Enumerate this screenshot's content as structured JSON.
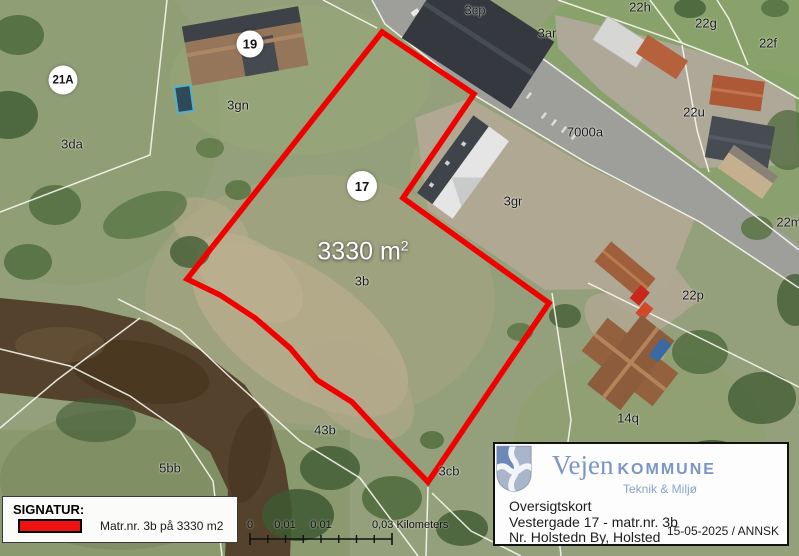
{
  "map": {
    "parcel_labels": [
      {
        "id": "3cp",
        "text": "3cp"
      },
      {
        "id": "3ar",
        "text": "3ar"
      },
      {
        "id": "22h",
        "text": "22h"
      },
      {
        "id": "22g",
        "text": "22g"
      },
      {
        "id": "22f",
        "text": "22f"
      },
      {
        "id": "7000a",
        "text": "7000a"
      },
      {
        "id": "22u",
        "text": "22u"
      },
      {
        "id": "22m",
        "text": "22m"
      },
      {
        "id": "22p",
        "text": "22p"
      },
      {
        "id": "3gn",
        "text": "3gn"
      },
      {
        "id": "3da",
        "text": "3da"
      },
      {
        "id": "3gr",
        "text": "3gr"
      },
      {
        "id": "3b",
        "text": "3b"
      },
      {
        "id": "43b",
        "text": "43b"
      },
      {
        "id": "5bb",
        "text": "5bb"
      },
      {
        "id": "3cb",
        "text": "3cb"
      },
      {
        "id": "14q",
        "text": "14q"
      }
    ],
    "address_badges": [
      {
        "text": "19"
      },
      {
        "text": "21A"
      },
      {
        "text": "17"
      }
    ],
    "area_label": {
      "value": "3330 m",
      "superscript": "2"
    },
    "highlight_color": "#f10000"
  },
  "legend": {
    "title": "SIGNATUR:",
    "swatch_color": "#ee1212",
    "entry": "Matr.nr. 3b på 3330 m2"
  },
  "scalebar": {
    "tick_labels": [
      "0",
      "0,01",
      "0,01"
    ],
    "end_label": "0,03 Kilometers"
  },
  "infobox": {
    "municipality": "Vejen",
    "municipality_suffix": "KOMMUNE",
    "department": "Teknik & Miljø",
    "brand_color": "#7b95c6",
    "map_type": "Oversigtskort",
    "address_line": "Vestergade 17 - matr.nr. 3b",
    "district_line": "Nr. Holstedn By, Holsted",
    "date_author": "15-05-2025 / ANNSK"
  }
}
